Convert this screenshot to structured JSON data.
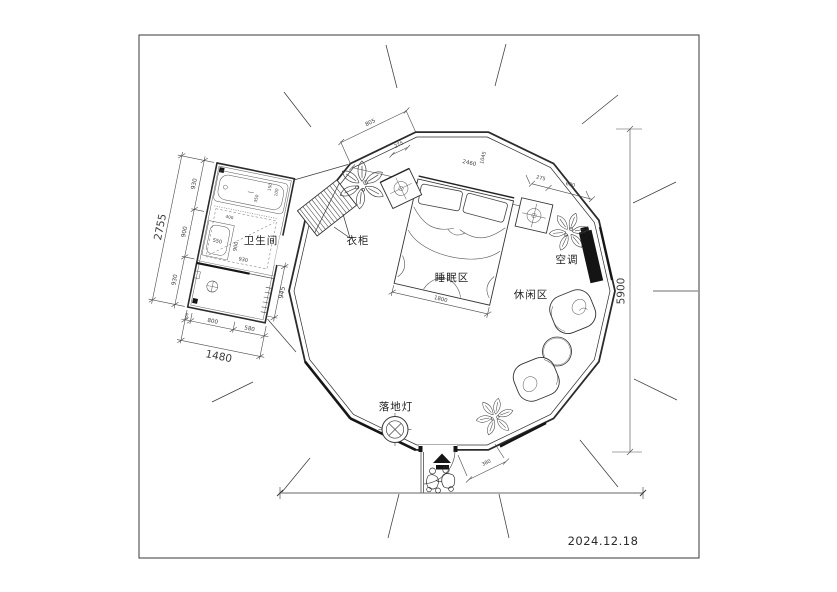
{
  "meta": {
    "date": "2024.12.18"
  },
  "labels": {
    "bathroom": "卫生间",
    "wardrobe": "衣柜",
    "sleeping_area": "睡眠区",
    "leisure_area": "休闲区",
    "air_conditioner": "空调",
    "floor_lamp": "落地灯"
  },
  "dimensions": {
    "diameter": "5900",
    "bed_width": "1800",
    "entrance": "380",
    "top": [
      "805",
      "275",
      "2460",
      "1045"
    ],
    "right_wall": [
      "275",
      "690"
    ],
    "bathroom": {
      "left_total": "2755",
      "left_segments": [
        "930",
        "900",
        "930"
      ],
      "bottom_total": "1480",
      "bottom_segments": [
        "100",
        "800",
        "580"
      ],
      "right_side": "945",
      "inner": [
        "550",
        "900",
        "930",
        "400",
        "350",
        "150",
        "100"
      ]
    }
  }
}
